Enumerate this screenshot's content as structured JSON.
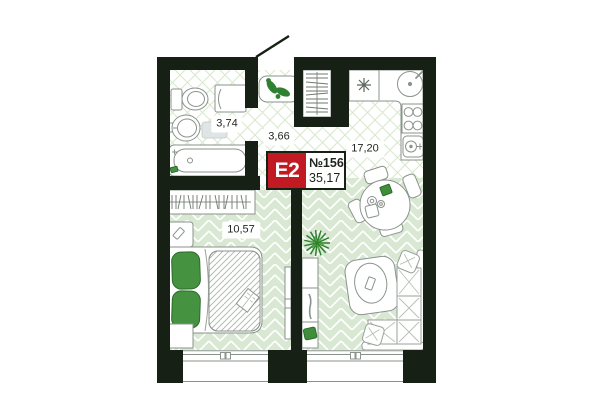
{
  "badge": {
    "type": "E2",
    "number": "№156",
    "area": "35,17"
  },
  "rooms": {
    "bathroom": "3,74",
    "hallway": "3,66",
    "kitchen_living": "17,20",
    "bedroom": "10,57"
  },
  "colors": {
    "wall": "#162015",
    "badge_red": "#c11a22",
    "floor_green": "#d9e8d2",
    "accent_green": "#459240"
  }
}
